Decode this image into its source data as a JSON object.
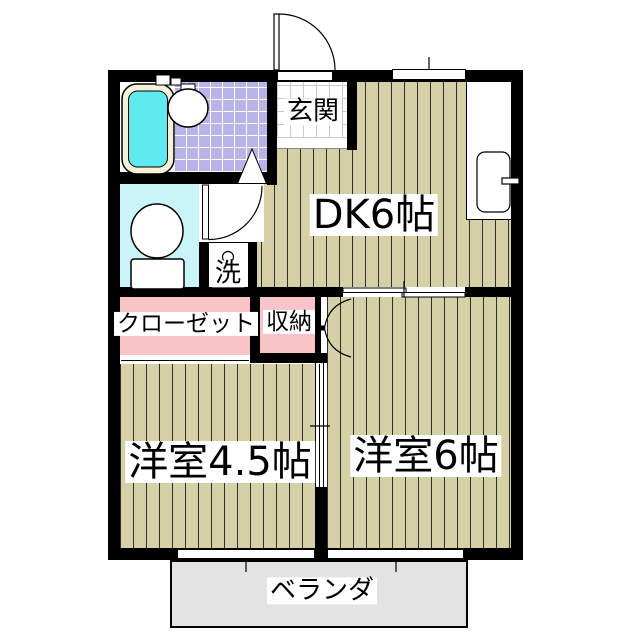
{
  "floorplan": {
    "type": "japanese-apartment-floor-plan",
    "rooms": {
      "genkan": {
        "label": "玄関"
      },
      "dk": {
        "label": "DK6帖"
      },
      "western6": {
        "label": "洋室6帖"
      },
      "western45": {
        "label": "洋室4.5帖"
      },
      "closet": {
        "label": "クローゼット"
      },
      "storage": {
        "label": "収納"
      },
      "laundry": {
        "label": "洗"
      },
      "veranda": {
        "label": "ベランダ"
      }
    },
    "fixtures": [
      "bathtub",
      "bathroom-sink",
      "toilet",
      "kitchen-counter-sink",
      "washing-machine-tap",
      "entrance-swing-door",
      "toilet-swing-door",
      "bathroom-folding-door-marker",
      "storage-folding-door",
      "sliding-door-dk-western6",
      "sliding-door-western45-western6",
      "closet-sliding-door",
      "windows"
    ],
    "colors": {
      "wall": "#000000",
      "wood_floor": "#d6d0a6",
      "bath_tile": "#b8b4e9",
      "toilet_floor": "#c9f4f8",
      "bathtub_water": "#5feaf0",
      "bathtub_rim": "#f6f2da",
      "closet_fill": "#f9c4c8",
      "veranda_fill": "#e3e3e3"
    }
  }
}
